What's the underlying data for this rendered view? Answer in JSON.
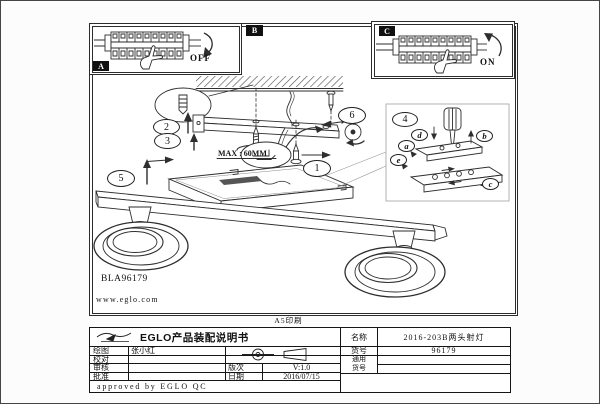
{
  "page": {
    "print_note": "A5印刷"
  },
  "diagram": {
    "code": "BLA96179",
    "website": "www.eglo.com",
    "max_note": "MAX : 60MM",
    "panel_a": "A",
    "panel_b": "B",
    "panel_c": "C",
    "off": "OFF",
    "on": "ON",
    "steps": [
      "1",
      "2",
      "3",
      "4",
      "5",
      "6"
    ],
    "parts": [
      "a",
      "b",
      "c",
      "d",
      "e"
    ]
  },
  "title_block": {
    "title": "EGLO产品装配说明书",
    "drawn_label": "绘图",
    "drawn_by": "张小红",
    "check_label": "校对",
    "review_label": "审核",
    "approve_label": "批准",
    "version_label": "版次",
    "version": "V:1.0",
    "date_label": "日期",
    "date": "2016/07/15",
    "qc_note": "approved by EGLO QC",
    "name_label": "名称",
    "product_name": "2016-203B两头射灯",
    "item_label": "货号",
    "item_no": "96179",
    "universal_label_1": "通用",
    "universal_label_2": "货号"
  }
}
